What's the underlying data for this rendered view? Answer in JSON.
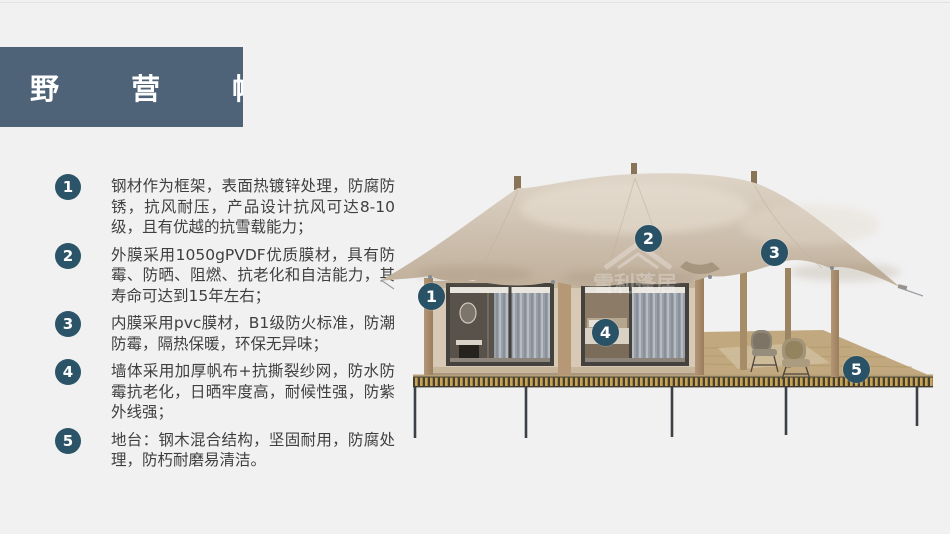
{
  "page": {
    "background": "#f1f1f1"
  },
  "title_banner": {
    "text": "野 营 帐 篷",
    "bg": "#4e6377",
    "color": "#ffffff"
  },
  "features": [
    {
      "num": "1",
      "text": "钢材作为框架，表面热镀锌处理，防腐防锈，抗风耐压，产品设计抗风可达8-10级，且有优越的抗雪载能力；"
    },
    {
      "num": "2",
      "text": "外膜采用1050gPVDF优质膜材，具有防霉、防晒、阻燃、抗老化和自洁能力，其寿命可达到15年左右；"
    },
    {
      "num": "3",
      "text": "内膜采用pvc膜材，B1级防火标准，防潮防霉，隔热保暖，环保无异味；"
    },
    {
      "num": "4",
      "text": "墙体采用加厚帆布+抗撕裂纱网，防水防霉抗老化，日晒牢度高，耐候性强，防紫外线强；"
    },
    {
      "num": "5",
      "text": "地台：钢木混合结构，坚固耐用，防腐处理，防朽耐磨易清洁。"
    }
  ],
  "figure": {
    "description": "安装在钢木地台上的野营帐篷（两间客房+侧边露台）",
    "watermark": "雪利蓬居",
    "callout_color": "#2a5266",
    "callouts": [
      {
        "num": "1"
      },
      {
        "num": "2"
      },
      {
        "num": "3"
      },
      {
        "num": "4"
      },
      {
        "num": "5"
      }
    ]
  },
  "colors": {
    "accent_badge": "#2b5468",
    "banner_bg": "#4e6377",
    "canopy": "#cfc1af",
    "wall": "#d7c9b5",
    "wood": "#ab8f6b",
    "deck": "#c1a87e",
    "platform_stripe": "#c9a452",
    "steel_leg": "#3b4046",
    "body_text": "#3f3f3f"
  }
}
